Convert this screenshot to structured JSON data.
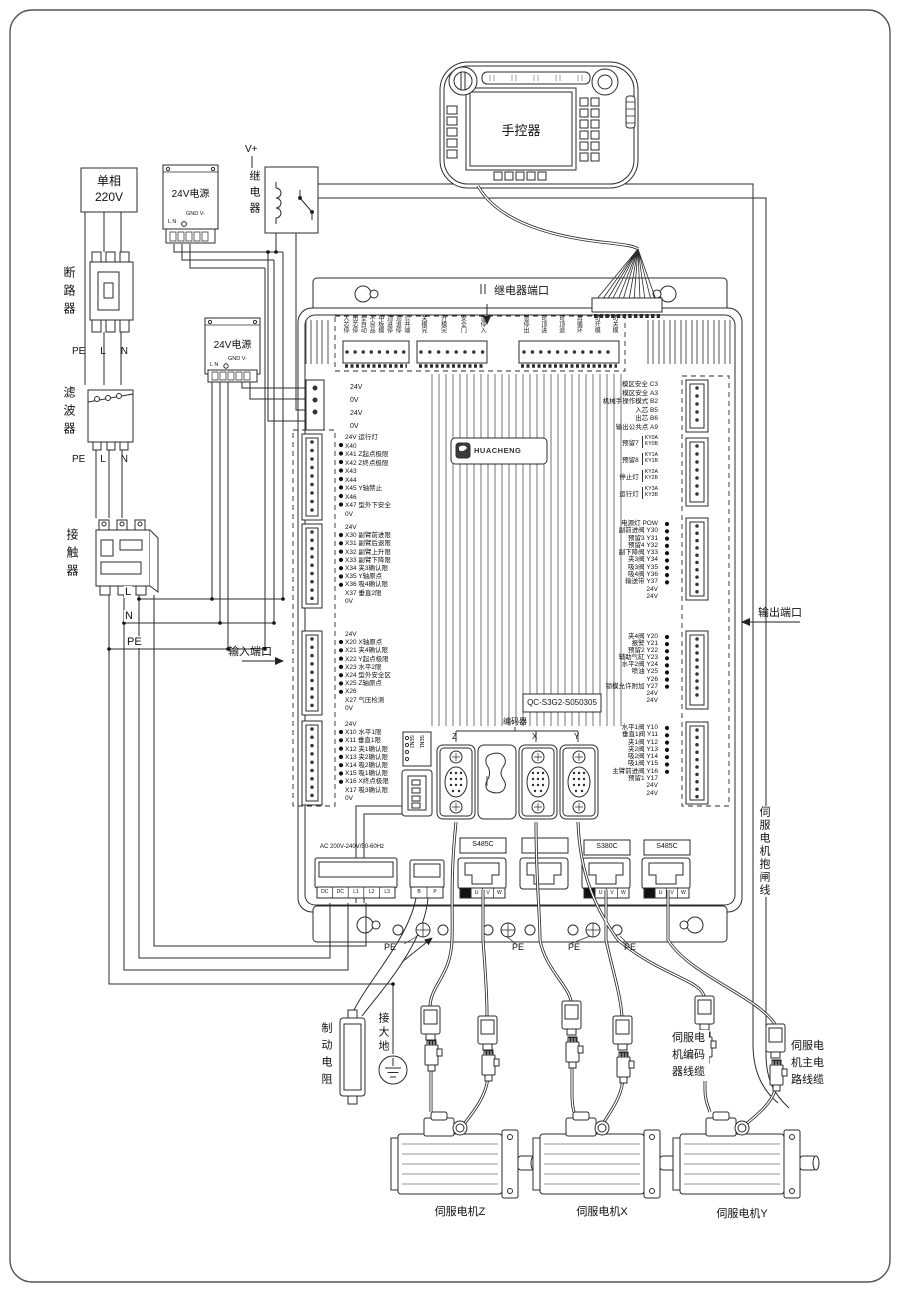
{
  "pendant": {
    "label": "手控器"
  },
  "left": {
    "source": "单相\n220V",
    "breaker": "断路器",
    "filter": "滤波器",
    "contactor": "接触器",
    "peln": [
      "PE",
      "L",
      "N"
    ],
    "bus_l": "L",
    "bus_n": "N",
    "bus_pe": "PE",
    "input_port": "输入端口"
  },
  "psu": {
    "label": "24V电源",
    "gnd": "GND V-",
    "ln": "L N",
    "vplus": "V+",
    "relay": "继电器"
  },
  "board": {
    "relay_port": "继电器端口",
    "output_port": "输出端口",
    "relay_b1": [
      "入芯停",
      "出芯停",
      "全自动",
      "不良品",
      "中板模",
      "顶进停",
      "顶退停",
      "公共端"
    ],
    "relay_b2": [
      "关模完",
      "开模完",
      "安全门",
      "急停入"
    ],
    "relay_b3": [
      "急停出",
      "可顶进",
      "可顶退",
      "再循环",
      "可开模",
      "可关模"
    ],
    "power_rows": [
      "24V",
      "0V",
      "24V",
      "0V"
    ],
    "in_g40": [
      "24V 运行灯",
      "X40",
      "X41 Z起点极限",
      "X42 Z终点极限",
      "X43",
      "X44",
      "X45 Y轴禁止",
      "X46",
      "X47 型外下安全",
      "0V"
    ],
    "in_g30": [
      "24V",
      "X30 副臂前进限",
      "X31 副臂后退限",
      "X32 副臂上升限",
      "X33 副臂下降限",
      "X34 夹3确认限",
      "X35 Y轴原点",
      "X36 吸4确认限",
      "X37 垂直2限",
      "0V"
    ],
    "in_g20": [
      "24V",
      "X20 X轴原点",
      "X21 夹4确认限",
      "X22 Y起点极限",
      "X23 水平2限",
      "X24 型外安全区",
      "X25 Z轴原点",
      "X26",
      "X27 气压检测",
      "0V"
    ],
    "in_g10": [
      "24V",
      "X10 水平1限",
      "X11 垂直1限",
      "X12 夹1确认限",
      "X13 夹2确认限",
      "X14 吸2确认限",
      "X15 吸1确认限",
      "X16 X终点极限",
      "X17 吸3确认限",
      "0V"
    ],
    "out_top": [
      "模区安全 C3",
      "模区安全 A3",
      "机械手操作模式 B2",
      "入芯 B5",
      "出芯 B6",
      "输出公共点 A9"
    ],
    "ky": [
      {
        "name": "预留7",
        "a": "KY0A",
        "b": "KY0B"
      },
      {
        "name": "预留8",
        "a": "KY1A",
        "b": "KY1B"
      },
      {
        "name": "停止灯",
        "a": "KY2A",
        "b": "KY2B"
      },
      {
        "name": "运行灯",
        "a": "KY3A",
        "b": "KY3B"
      }
    ],
    "out_g30": [
      "电源灯 POW",
      "副前进阀 Y30",
      "预留3 Y31",
      "预留4 Y32",
      "副下降阀 Y33",
      "夹3阀 Y34",
      "吸3阀 Y35",
      "吸4阀 Y36",
      "输送带 Y37",
      "24V",
      "24V"
    ],
    "out_g20": [
      "夹4阀 Y20",
      "报警 Y21",
      "预留2 Y22",
      "辅助气缸 Y23",
      "水平2阀 Y24",
      "喷油 Y25",
      "Y26",
      "锁模允许附加 Y27",
      "24V",
      "24V"
    ],
    "out_g10": [
      "水平1阀 Y10",
      "垂直1阀 Y11",
      "夹1阀 Y12",
      "夹2阀 Y13",
      "吸2阀 Y14",
      "吸1阀 Y15",
      "主臂前进阀 Y16",
      "预留1 Y17",
      "24V",
      "24V"
    ],
    "logo": "HUACHENG",
    "model": "QC-S3G2-S050305",
    "encoder": "编码器",
    "axes": [
      "Z",
      "X",
      "Y"
    ],
    "sen": [
      "SEN2",
      "SEN1"
    ],
    "ac": "AC 200V-240V/50-60Hz",
    "pwr_pins": [
      "DC",
      "DC",
      "L1",
      "L2",
      "L3"
    ],
    "bp_pins": [
      "B",
      "P"
    ],
    "drives": [
      "S485C",
      "S380C",
      "S485C"
    ],
    "uvw": [
      "U",
      "V",
      "W"
    ],
    "pe": [
      "PE",
      "PE",
      "PE",
      "PE"
    ]
  },
  "bottom": {
    "brake_res": "制动电阻",
    "earth": "接大地",
    "motors": [
      "伺服电机Z",
      "伺服电机X",
      "伺服电机Y"
    ],
    "cable_enc": "伺服电机编码器线缆",
    "cable_pwr": "伺服电机主电路线缆",
    "cable_brk": "伺服电机抱闸线"
  }
}
